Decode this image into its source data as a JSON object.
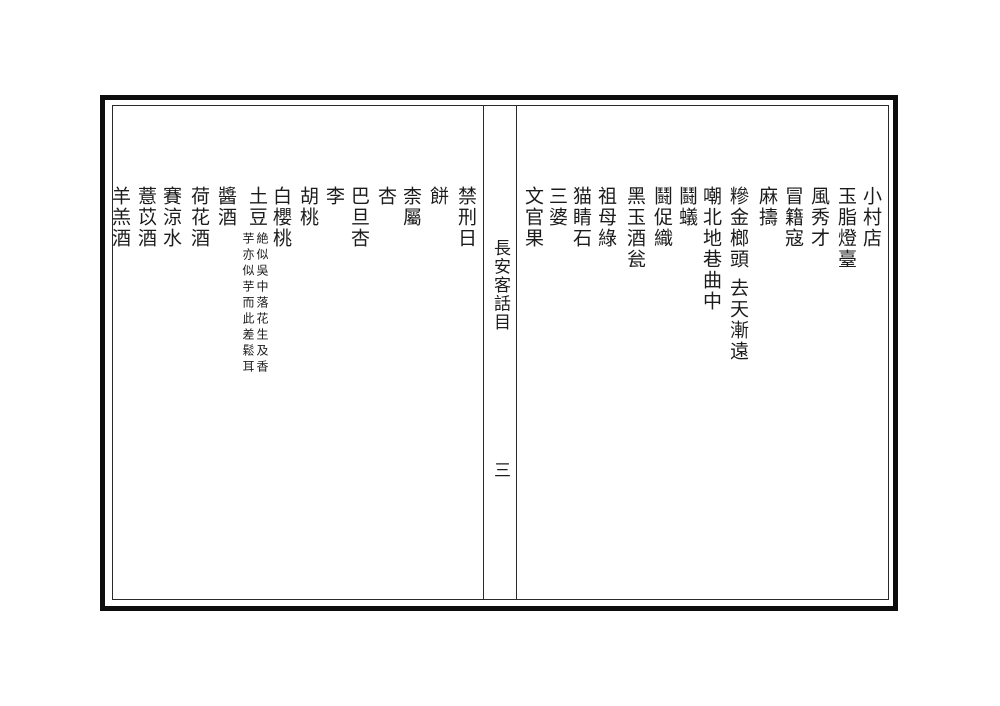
{
  "spine": {
    "title": "長安客話目",
    "folio": "三"
  },
  "right_page": {
    "entries": [
      {
        "text": "小村店"
      },
      {
        "text": "玉脂燈臺"
      },
      {
        "text": "風秀才"
      },
      {
        "text": "冒籍寇"
      },
      {
        "text": "麻擣"
      },
      {
        "text": "糝金榔頭"
      },
      {
        "text": "去天漸遠"
      },
      {
        "text": "嘲北地巷曲中"
      },
      {
        "text": "鬪蟻"
      },
      {
        "text": "鬪促織"
      },
      {
        "text": "黑玉酒瓮"
      },
      {
        "text": "祖母綠"
      },
      {
        "text": "猫睛石"
      },
      {
        "text": "三婆"
      },
      {
        "text": "文官果"
      }
    ]
  },
  "left_page": {
    "entries": [
      {
        "text": "禁刑日"
      },
      {
        "text": "餅"
      },
      {
        "text": "柰屬"
      },
      {
        "text": "杏"
      },
      {
        "text": "巴旦杏"
      },
      {
        "text": "李"
      },
      {
        "text": "胡桃"
      },
      {
        "text": "白櫻桃"
      },
      {
        "text": "土豆"
      },
      {
        "text": "醬酒"
      },
      {
        "text": "荷花酒"
      },
      {
        "text": "賽涼水"
      },
      {
        "text": "薏苡酒"
      },
      {
        "text": "羊羔酒"
      }
    ],
    "tudou_note": {
      "column_right": "絶似吳中落花生及香",
      "column_left": "芋亦似芋而此差鬆耳"
    }
  },
  "colors": {
    "ink": "#1c1c1c",
    "paper": "#ffffff",
    "border": "#0d0d0d"
  }
}
